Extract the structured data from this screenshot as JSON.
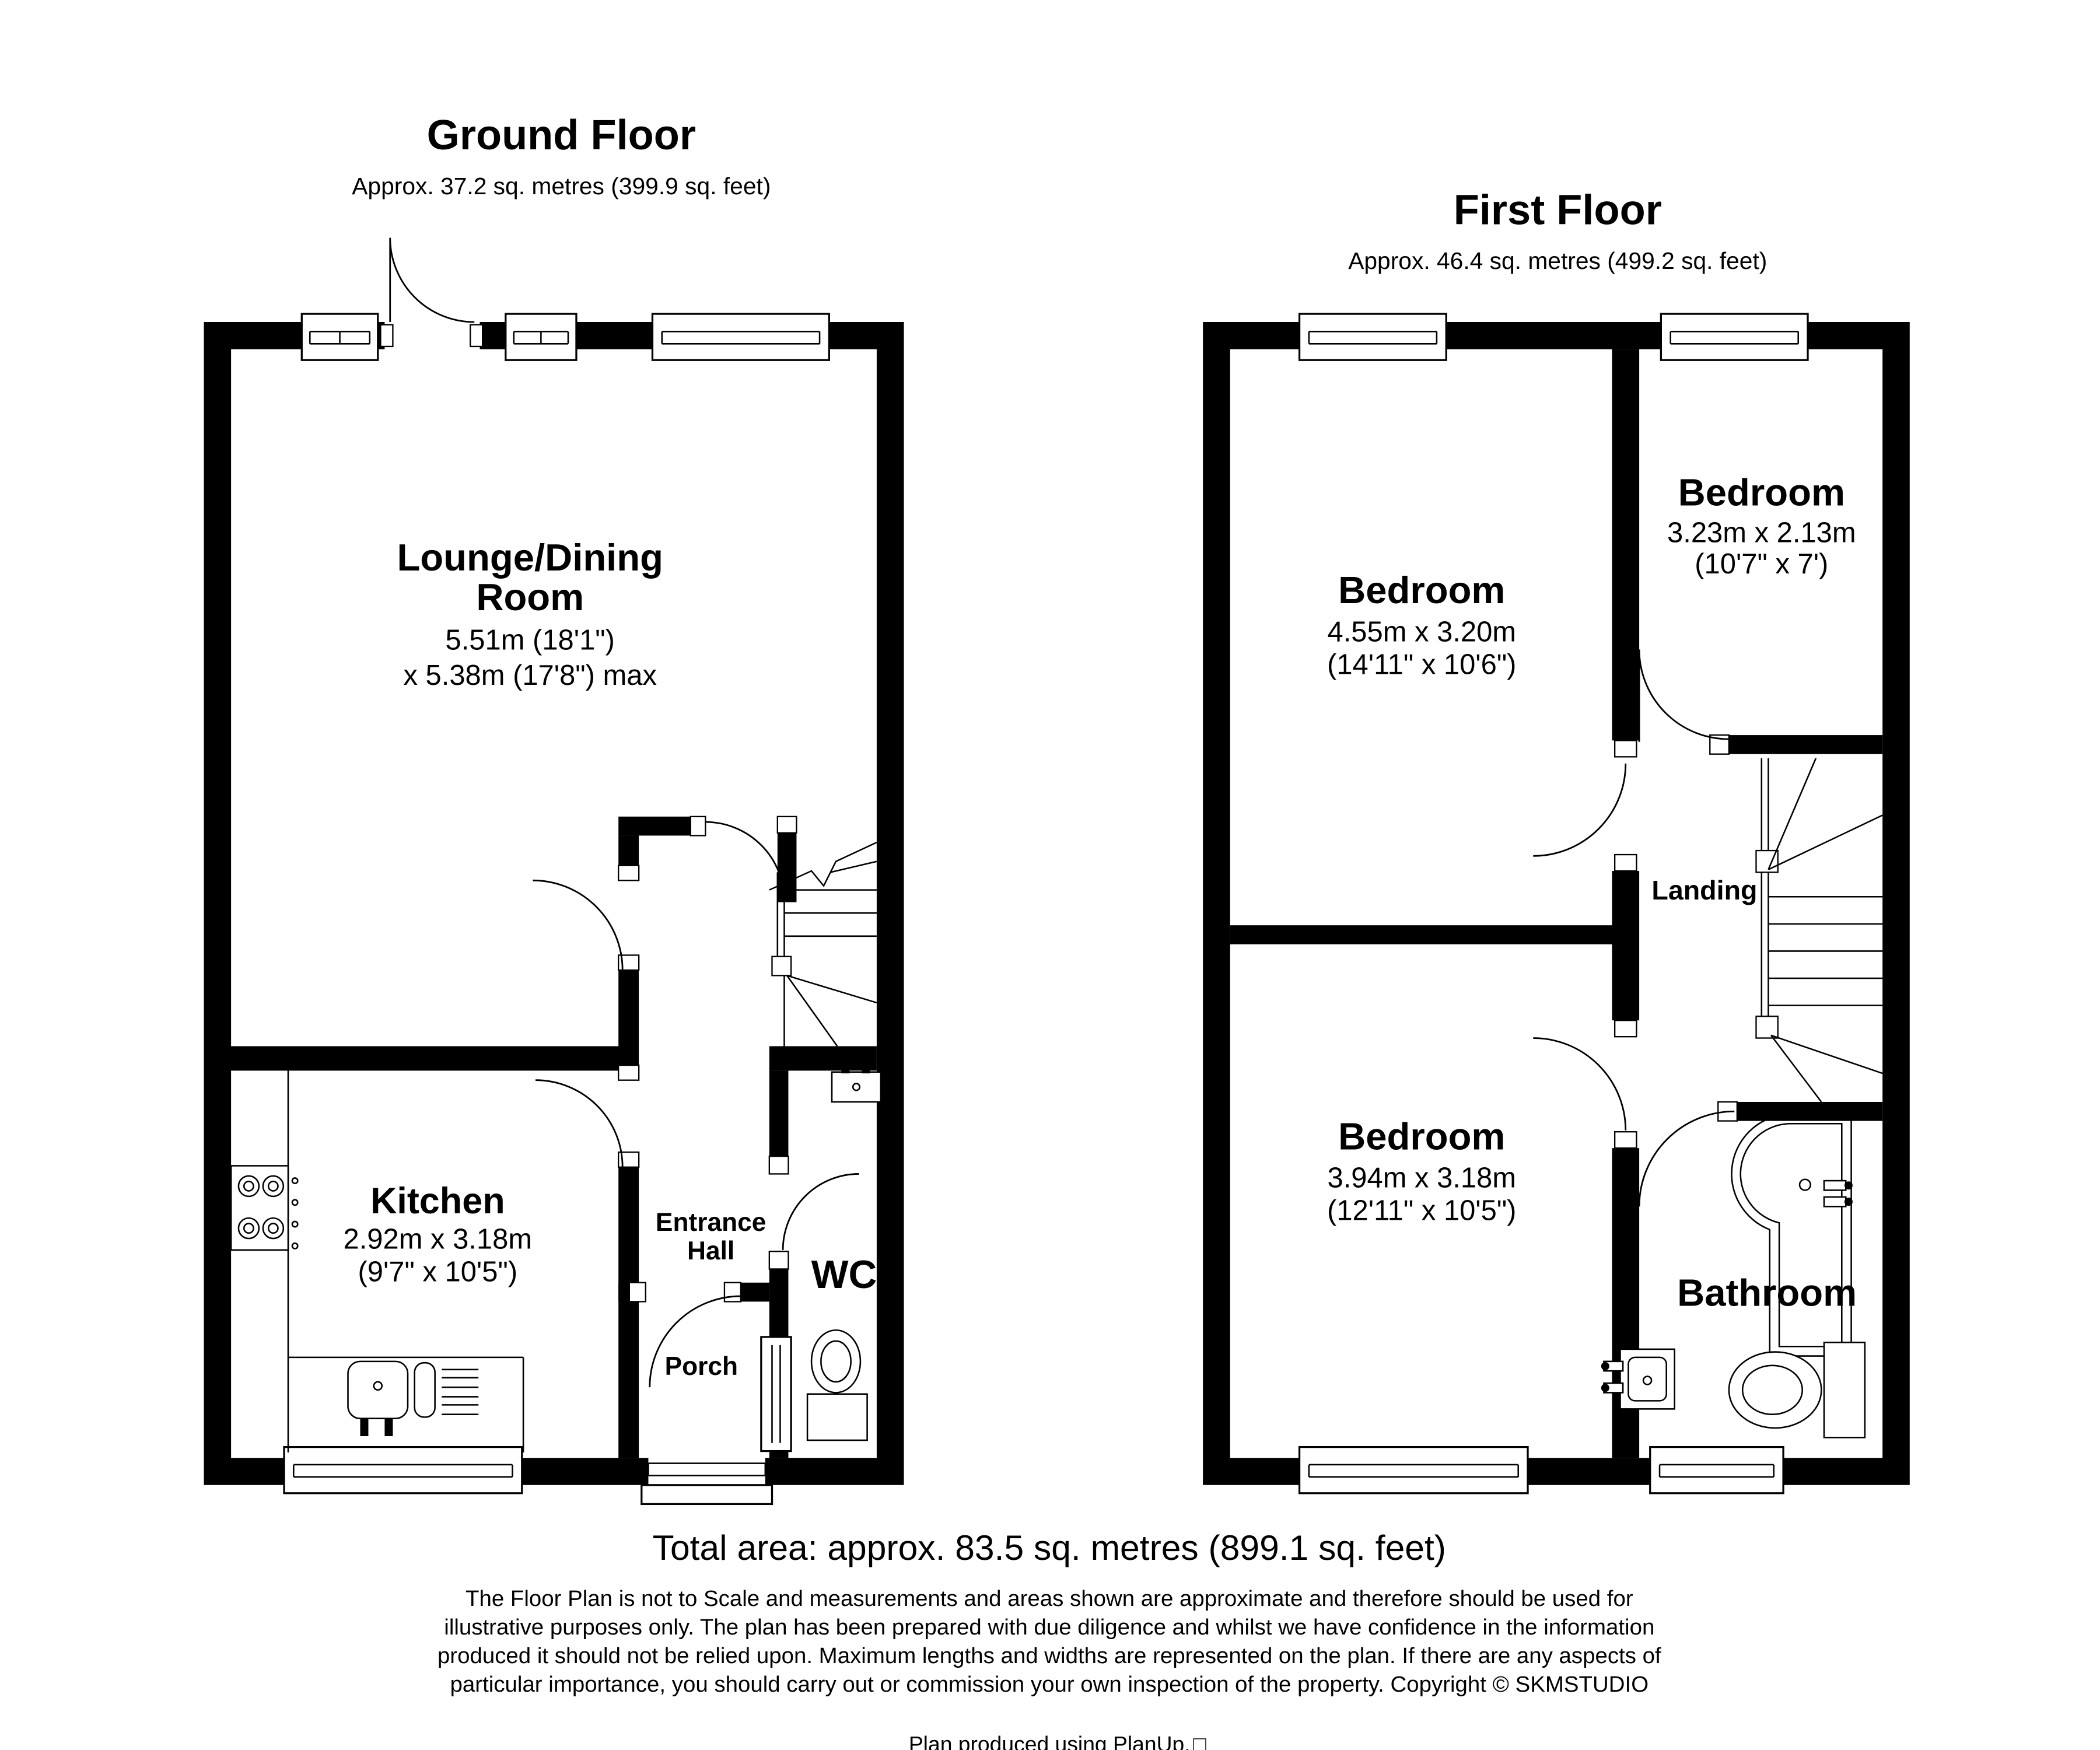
{
  "ground_floor": {
    "title": "Ground Floor",
    "area": "Approx. 37.2 sq. metres (399.9 sq. feet)",
    "rooms": {
      "lounge": {
        "name_line1": "Lounge/Dining",
        "name_line2": "Room",
        "dim_line1": "5.51m (18'1\")",
        "dim_line2": "x 5.38m (17'8\") max"
      },
      "kitchen": {
        "name": "Kitchen",
        "dim_line1": "2.92m x 3.18m",
        "dim_line2": "(9'7\" x 10'5\")"
      },
      "entrance_hall": {
        "name_line1": "Entrance",
        "name_line2": "Hall"
      },
      "wc": {
        "name": "WC"
      },
      "porch": {
        "name": "Porch"
      }
    }
  },
  "first_floor": {
    "title": "First Floor",
    "area": "Approx. 46.4 sq. metres (499.2 sq. feet)",
    "rooms": {
      "bedroom_left": {
        "name": "Bedroom",
        "dim_line1": "4.55m x 3.20m",
        "dim_line2": "(14'11\" x 10'6\")"
      },
      "bedroom_top_right": {
        "name": "Bedroom",
        "dim_line1": "3.23m x 2.13m",
        "dim_line2": "(10'7\" x 7')"
      },
      "bedroom_bottom": {
        "name": "Bedroom",
        "dim_line1": "3.94m x 3.18m",
        "dim_line2": "(12'11\" x 10'5\")"
      },
      "landing": {
        "name": "Landing"
      },
      "bathroom": {
        "name": "Bathroom"
      }
    }
  },
  "footer": {
    "total_area": "Total area: approx. 83.5 sq. metres (899.1 sq. feet)",
    "disclaimer_lines": [
      "The Floor Plan is not to Scale and measurements and areas shown are approximate and therefore should be used for",
      "illustrative purposes only. The plan has been prepared with due diligence and whilst we have confidence in the information",
      "produced it should not be relied upon. Maximum lengths and widths are represented on the plan. If there are any aspects of",
      "particular importance, you should carry out or commission your own inspection of the property. Copyright © SKMSTUDIO"
    ],
    "produced": "Plan produced using PlanUp.",
    "produced_glyph": "□"
  },
  "colors": {
    "wall": "#000000",
    "background": "#ffffff"
  }
}
